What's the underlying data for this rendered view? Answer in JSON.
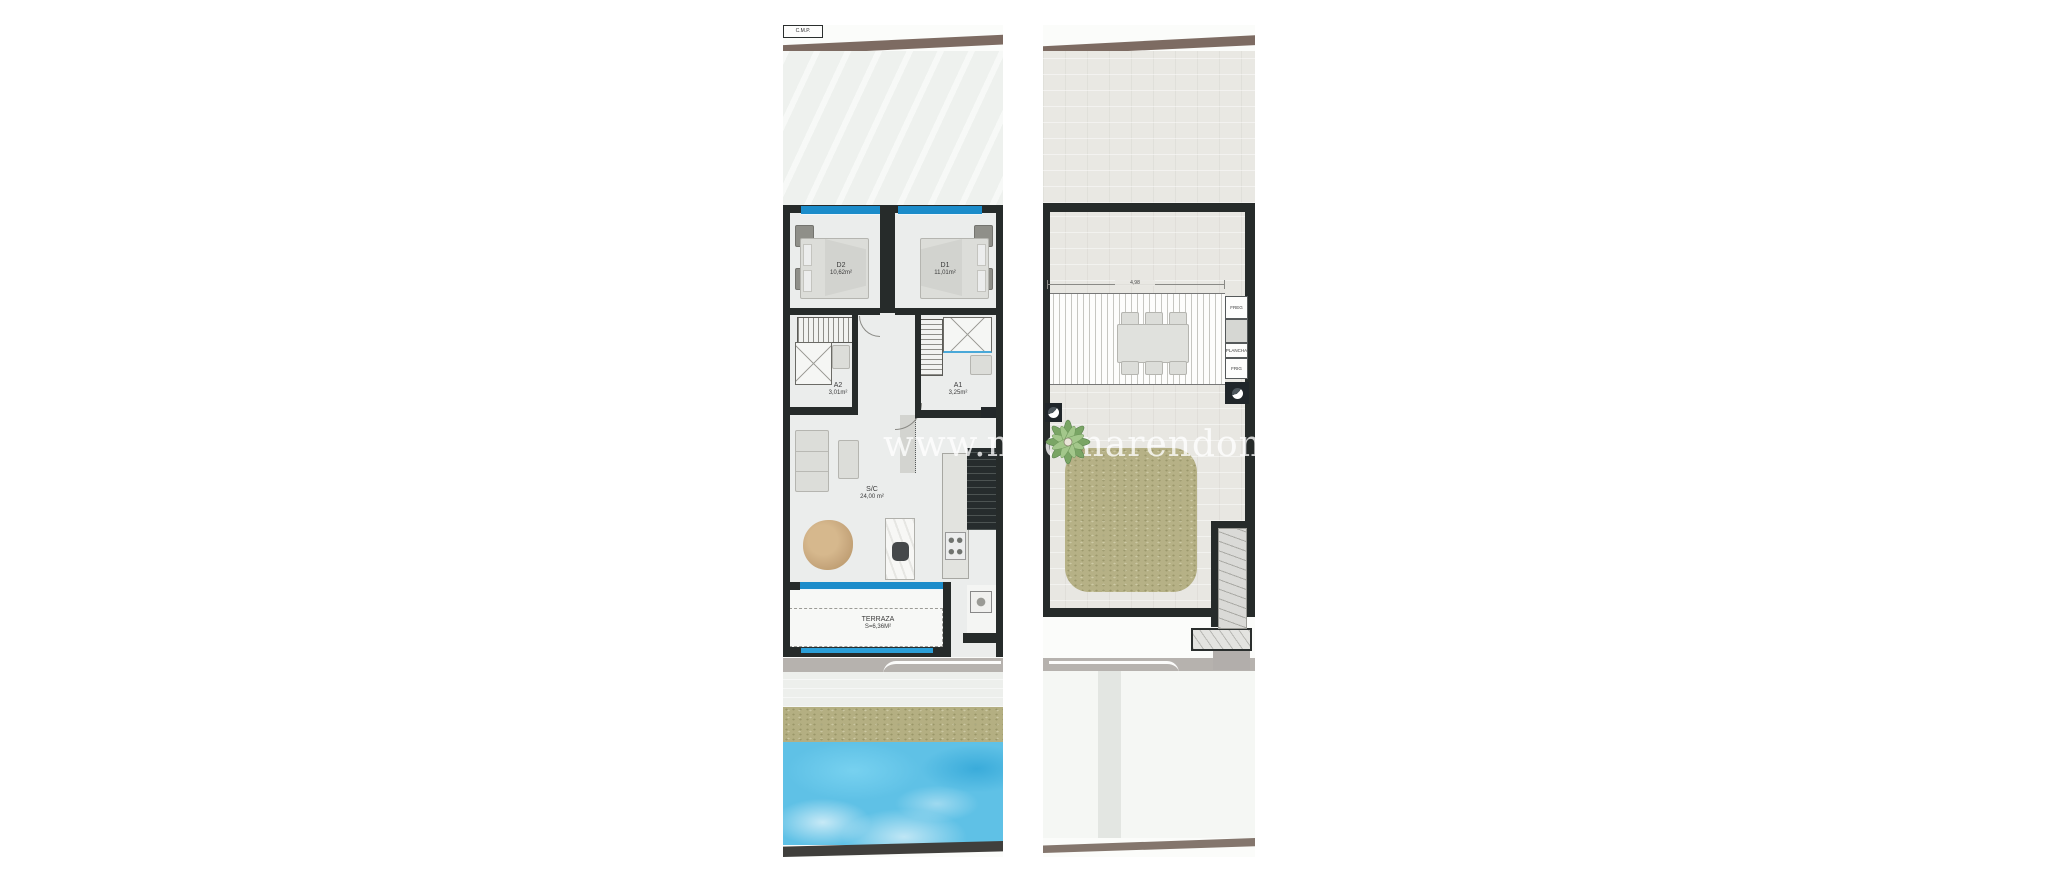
{
  "watermark": {
    "text": "www.medinarendom.com"
  },
  "plans": {
    "left": {
      "title": "apartment-floor-plan",
      "rooms": {
        "d2": {
          "code": "D2",
          "area": "10,62m²"
        },
        "d1": {
          "code": "D1",
          "area": "11,01m²"
        },
        "a2": {
          "code": "A2",
          "area": "3,01m²"
        },
        "a1": {
          "code": "A1",
          "area": "3,25m²"
        },
        "sc": {
          "code": "S/C",
          "area": "24,00 m²"
        },
        "terrace": {
          "code": "TERRAZA",
          "area": "S=6,36M²"
        },
        "cmp": {
          "code": "C.M.P."
        }
      }
    },
    "right": {
      "title": "solarium-roof-plan",
      "pergola": {
        "dimension": "4,98"
      },
      "outdoor_kitchen": {
        "sink": "FREG",
        "grill": "PLANCHA",
        "fridge": "FRIG"
      }
    }
  },
  "colors": {
    "wall": "#262b2a",
    "window_blue": "#1b8cca",
    "road_brown": "#7d6b62",
    "grass_band": "#b4af82",
    "pool_blue": "#5fc1e6",
    "lawn_green": "#b6b186",
    "table_wood": "#c8a87e"
  }
}
